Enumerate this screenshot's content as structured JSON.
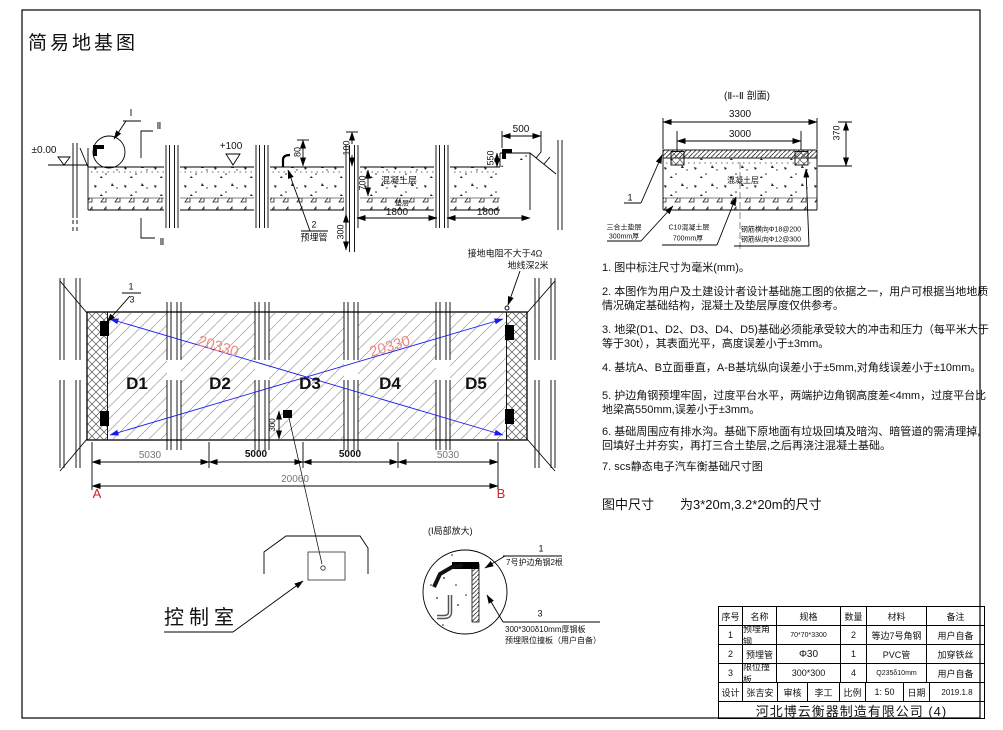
{
  "colors": {
    "blue": "#1a1aee",
    "red": "#d42222",
    "salmon": "#ee8a84",
    "dim_gray": "#767676"
  },
  "title": "简易地基图",
  "profile": {
    "level_zero": "±0.00",
    "level_plus": "+100",
    "cut_top": "Ⅱ",
    "cut_bottom": "Ⅱ",
    "detail_ref": "I",
    "dim_80": "80",
    "dim_100": "100",
    "dim_700": "700",
    "dim_300_pipe": "300",
    "dim_550": "550",
    "dim_500": "500",
    "dim_1800_a": "1800",
    "dim_1800_b": "1800",
    "concrete_label": "混凝土层",
    "cushion_label": "垫层",
    "pipe_callout_num": "2",
    "pipe_callout": "预埋管"
  },
  "section2": {
    "title": "(Ⅱ--Ⅱ 剖面)",
    "dim_3300": "3300",
    "dim_3000": "3000",
    "dim_370": "370",
    "concrete_label": "混凝土层",
    "ref_1": "1",
    "cushion_callout_1": "三合土垫层",
    "cushion_callout_2": "300mm厚",
    "concrete_callout_1": "C10混凝土层",
    "concrete_callout_2": "700mm厚",
    "rebar_callout_1": "钢筋横向Φ18@200",
    "rebar_callout_2": "钢筋纵向Φ12@300"
  },
  "plan": {
    "modules": [
      "D1",
      "D2",
      "D3",
      "D4",
      "D5"
    ],
    "diagonal_dim": "20330",
    "ground_note_1": "接地电阻不大于4Ω",
    "ground_note_2": "地线深2米",
    "cell_ref_top": "1",
    "cell_ref_bottom": "3",
    "dim_segments": [
      "5030",
      "5000",
      "5000",
      "5030"
    ],
    "dim_total": "20060",
    "corner_a": "A",
    "corner_b": "B",
    "junction_dim": "300",
    "control_room_label": "控制室"
  },
  "detail": {
    "title": "(Ⅰ局部放大)",
    "ref_1": "1",
    "callout_1": "7号护边角钢2根",
    "ref_3": "3",
    "callout_3_line1": "300*300δ10mm厚钢板",
    "callout_3_line2": "预埋限位撞板（用户自备）"
  },
  "notes": [
    "1. 图中标注尺寸为毫米(mm)。",
    "2. 本图作为用户及土建设计者设计基础施工图的依据之一，用户可根据当地地质情况确定基础结构，混凝土及垫层厚度仅供参考。",
    "3. 地梁(D1、D2、D3、D4、D5)基础必须能承受较大的冲击和压力（每平米大于等于30t），其表面光平，高度误差小于±3mm。",
    "4. 基坑A、B立面垂直，A-B基坑纵向误差小于±5mm,对角线误差小于±10mm。",
    "5. 护边角钢预埋牢固，过度平台水平，两端护边角钢高度差<4mm，过度平台比地梁高550mm,误差小于±3mm。",
    "6. 基础周围应有排水沟。基础下原地面有垃圾回填及暗沟、暗管道的需清理掉,回填好土并夯实，再打三合土垫层,之后再浇注混凝土基础。",
    "7. scs静态电子汽车衡基础尺寸图"
  ],
  "notes_footer": "图中尺寸　　为3*20m,3.2*20m的尺寸",
  "table": {
    "headers": [
      "序号",
      "名称",
      "规格",
      "数量",
      "材料",
      "备注"
    ],
    "rows": [
      [
        "1",
        "预埋角钢",
        "70*70*3300",
        "2",
        "等边7号角钢",
        "用户自备"
      ],
      [
        "2",
        "预埋管",
        "Φ30",
        "1",
        "PVC管",
        "加穿铁丝"
      ],
      [
        "3",
        "限位撞板",
        "300*300",
        "4",
        "Q235δ10mm",
        "用户自备"
      ]
    ],
    "footer": {
      "design_label": "设计",
      "designer": "张吉安",
      "review_label": "审核",
      "reviewer": "李工",
      "scale_label": "比例",
      "scale_value": "1: 50",
      "date_label": "日期",
      "date_value": "2019.1.8"
    },
    "company": "河北博云衡器制造有限公司 (4)"
  }
}
